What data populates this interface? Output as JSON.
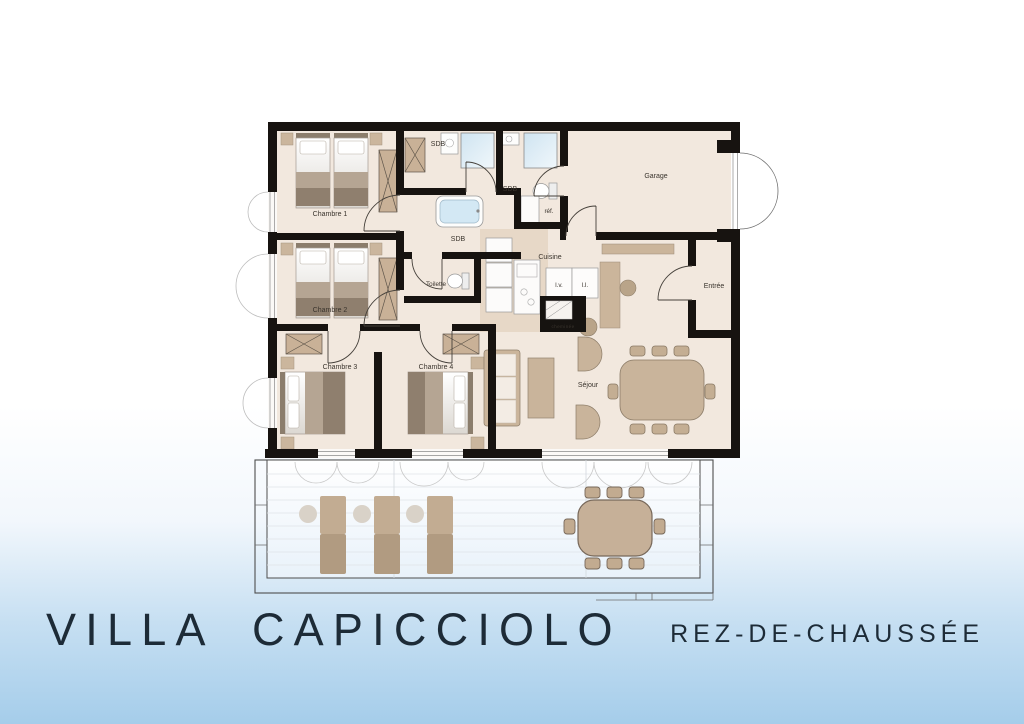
{
  "poster": {
    "title": "VILLA CAPICCIOLO",
    "subtitle": "REZ-DE-CHAUSSÉE"
  },
  "floorplan": {
    "labels": {
      "chambre1": "Chambre 1",
      "chambre2": "Chambre 2",
      "chambre3": "Chambre 3",
      "chambre4": "Chambre 4",
      "sdb_top": "SDB",
      "sdb_middle": "SDB",
      "sdb_bath": "SDB",
      "toilette": "Toilette",
      "cuisine": "Cuisine",
      "refrigerateur": "réf.",
      "lave_vaisselle": "l.v.",
      "lave_linge": "l.l.",
      "cheminee": "cheminée",
      "garage": "Garage",
      "entree": "Entrée",
      "sejour": "Séjour"
    },
    "colors": {
      "wall": "#171310",
      "room_floor": "#f2e8de",
      "kitchen_floor": "#e7d8c7",
      "furniture_beige": "#c6b098",
      "furniture_dark": "#8f7f6e",
      "shower_blue": "#d7eaf5",
      "background_blue": "#a5cdea",
      "label_text": "#3a342d",
      "title_text": "#1d2b37"
    }
  }
}
